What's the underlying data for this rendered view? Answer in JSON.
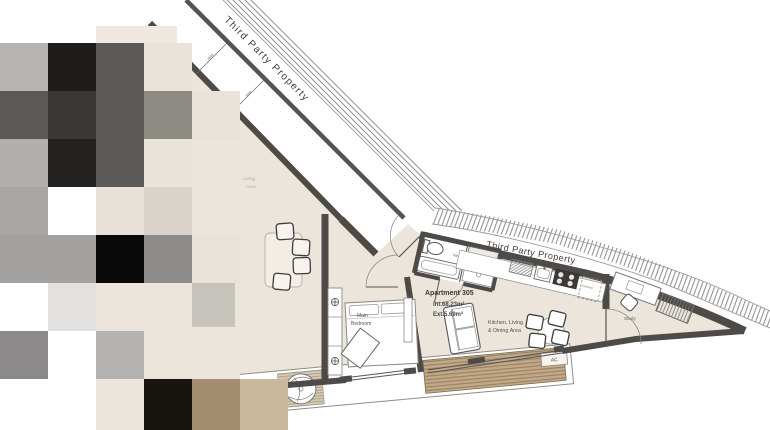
{
  "meta": {
    "title": "Apartment 305 floor plan"
  },
  "labels": {
    "third_party_top": "Third Party Property",
    "third_party_right": "Third Party Property",
    "apartment_title": "Apartment 305",
    "int_area": "Int.68.23m²",
    "ext_area": "Ext.5.69m²",
    "kitchen_line1": "Kitchen, Living",
    "kitchen_line2": "& Dining Area",
    "bedroom_line1": "Main",
    "bedroom_line2": "Bedroom",
    "study": "Study",
    "bathroom": "Bathroom",
    "living_line1": "Living",
    "living_line2": "Area",
    "ac": "AC"
  },
  "colors": {
    "wall": "#4d4a47",
    "wall_thin": "#55524f",
    "floor": "#ece5db",
    "hatch_line": "#8b8b8b",
    "deck": "#c2a98a",
    "deck_stripe": "#97815f",
    "label_dark": "#3a3937",
    "label_gray": "#5b5955",
    "faint_label": "#b7ada0"
  },
  "mosaic": {
    "cell_size": 48,
    "cells": [
      {
        "x": 96,
        "y": 26,
        "w": 48,
        "h": 17,
        "c": "#efe8df"
      },
      {
        "x": 144,
        "y": 26,
        "w": 33,
        "h": 17,
        "c": "#efe8df"
      },
      {
        "x": 0,
        "y": 43,
        "w": 48,
        "h": 48,
        "c": "#b6b4b2"
      },
      {
        "x": 48,
        "y": 43,
        "w": 48,
        "h": 48,
        "c": "#1e1d1c"
      },
      {
        "x": 96,
        "y": 43,
        "w": 48,
        "h": 48,
        "c": "#5c5a58"
      },
      {
        "x": 144,
        "y": 43,
        "w": 48,
        "h": 48,
        "c": "#e9e2d9"
      },
      {
        "x": 0,
        "y": 91,
        "w": 48,
        "h": 48,
        "c": "#5b5957"
      },
      {
        "x": 48,
        "y": 91,
        "w": 48,
        "h": 48,
        "c": "#3a3835"
      },
      {
        "x": 96,
        "y": 91,
        "w": 48,
        "h": 48,
        "c": "#5c5a58"
      },
      {
        "x": 144,
        "y": 91,
        "w": 48,
        "h": 48,
        "c": "#8d8a84"
      },
      {
        "x": 192,
        "y": 91,
        "w": 48,
        "h": 48,
        "c": "#eae3da"
      },
      {
        "x": 0,
        "y": 139,
        "w": 48,
        "h": 48,
        "c": "#b2b0ae"
      },
      {
        "x": 48,
        "y": 139,
        "w": 48,
        "h": 48,
        "c": "#232120"
      },
      {
        "x": 96,
        "y": 139,
        "w": 48,
        "h": 48,
        "c": "#5c5a58"
      },
      {
        "x": 144,
        "y": 139,
        "w": 48,
        "h": 48,
        "c": "#eae3da"
      },
      {
        "x": 0,
        "y": 187,
        "w": 48,
        "h": 48,
        "c": "#a9a7a5"
      },
      {
        "x": 48,
        "y": 187,
        "w": 48,
        "h": 48,
        "c": "#ffffff"
      },
      {
        "x": 96,
        "y": 187,
        "w": 48,
        "h": 48,
        "c": "#e8e1d8"
      },
      {
        "x": 144,
        "y": 187,
        "w": 48,
        "h": 48,
        "c": "#d9d3cb"
      },
      {
        "x": 0,
        "y": 235,
        "w": 96,
        "h": 48,
        "c": "#a3a1a0"
      },
      {
        "x": 96,
        "y": 235,
        "w": 48,
        "h": 48,
        "c": "#0a0a0a"
      },
      {
        "x": 144,
        "y": 235,
        "w": 48,
        "h": 48,
        "c": "#8e8c8a"
      },
      {
        "x": 192,
        "y": 235,
        "w": 48,
        "h": 48,
        "c": "#e9e2d9"
      },
      {
        "x": 0,
        "y": 283,
        "w": 48,
        "h": 48,
        "c": "#ffffff"
      },
      {
        "x": 48,
        "y": 283,
        "w": 48,
        "h": 48,
        "c": "#e3e1df"
      },
      {
        "x": 96,
        "y": 283,
        "w": 96,
        "h": 48,
        "c": "#ebe4db"
      },
      {
        "x": 192,
        "y": 283,
        "w": 43,
        "h": 44,
        "c": "#c7c3bd"
      },
      {
        "x": 0,
        "y": 331,
        "w": 48,
        "h": 48,
        "c": "#8b8989"
      },
      {
        "x": 48,
        "y": 331,
        "w": 48,
        "h": 48,
        "c": "#ffffff"
      },
      {
        "x": 96,
        "y": 331,
        "w": 48,
        "h": 48,
        "c": "#b5b3b1"
      },
      {
        "x": 144,
        "y": 331,
        "w": 96,
        "h": 48,
        "c": "#ebe4db"
      },
      {
        "x": 0,
        "y": 379,
        "w": 96,
        "h": 51,
        "c": "#ffffff"
      },
      {
        "x": 96,
        "y": 379,
        "w": 48,
        "h": 51,
        "c": "#ece5dc"
      },
      {
        "x": 144,
        "y": 379,
        "w": 48,
        "h": 51,
        "c": "#17130f"
      },
      {
        "x": 192,
        "y": 379,
        "w": 48,
        "h": 51,
        "c": "#a28d6e"
      },
      {
        "x": 240,
        "y": 379,
        "w": 48,
        "h": 51,
        "c": "#c9b89e"
      }
    ]
  }
}
